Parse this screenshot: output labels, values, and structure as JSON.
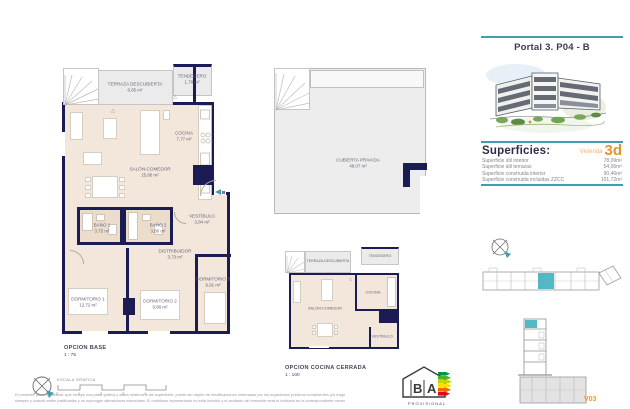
{
  "header": {
    "title": "Portal 3. P04 - B"
  },
  "superficies": {
    "title": "Superficies:",
    "vivienda_label": "Vivienda",
    "vivienda_code": "3d",
    "rows": [
      {
        "label": "Superficie útil interior",
        "value": "78,09m²"
      },
      {
        "label": "Superficie útil terrazas",
        "value": "54,06m²"
      },
      {
        "label": "Superficie construida interior",
        "value": "90,46m²"
      },
      {
        "label": "Superficie construida incluidas ZZCC",
        "value": "101,72m²"
      }
    ]
  },
  "plan_base": {
    "title": "OPCION BASE",
    "scale": "1 : 75",
    "section_marker": "B",
    "rooms": {
      "terraza": {
        "name": "TERRAZA DESCUBIERTA",
        "area": "6,85 m²"
      },
      "tendedero": {
        "name": "TENDEDERO",
        "area": "1,78 m²"
      },
      "cocina": {
        "name": "COCINA",
        "area": "7,77 m²"
      },
      "salon": {
        "name": "SALÓN-COMEDOR",
        "area": "25,86 m²"
      },
      "bano1": {
        "name": "BAÑO 1",
        "area": "3,75 m²"
      },
      "bano2": {
        "name": "BAÑO 2",
        "area": "3,86 m²"
      },
      "vestibulo": {
        "name": "VESTÍBULO",
        "area": "3,84 m²"
      },
      "distribuidor": {
        "name": "DISTRIBUIDOR",
        "area": "3,73 m²"
      },
      "dormitorio1": {
        "name": "DORMITORIO 1",
        "area": "12,72 m²"
      },
      "dormitorio2": {
        "name": "DORMITORIO 2",
        "area": "9,88 m²"
      },
      "dormitorio3": {
        "name": "DORMITORIO 3",
        "area": "9,91 m²"
      }
    }
  },
  "plan_cubierta": {
    "room": {
      "name": "CUBIERTA PRIVADA",
      "area": "48,07 m²"
    }
  },
  "plan_cerrada": {
    "title": "OPCION COCINA CERRADA",
    "scale": "1 : 100",
    "rooms": {
      "terraza": {
        "name": "TERRAZA DESCUBIERTA"
      },
      "tendedero": {
        "name": "TENDEDERO"
      },
      "salon": {
        "name": "SALÓN-COMEDOR"
      },
      "cocina": {
        "name": "COCINA"
      },
      "vestibulo": {
        "name": "VESTÍBULO"
      }
    }
  },
  "scalebar": {
    "label": "ESCALA GRÁFICA",
    "ticks": [
      "0",
      "1",
      "2",
      "3",
      "4"
    ]
  },
  "energy_logo": {
    "letter_b": "B",
    "letter_a": "A",
    "caption": "PROVISIONAL"
  },
  "footer": {
    "legal_line1": "El presente plano comercial, que incluye una parte gráfica y datos relativos a las superficies, puede ser objeto de modificaciones ordenadas por los organismos públicos competentes y/o exigencias técnicas o jurídicas,",
    "legal_line2": "siempre y cuando estén justificadas y no supongan alteraciones esenciales. El mobiliario representado no está incluido y el acabado del inmueble será el indicado en la correspondiente memoria de calidades.",
    "version": "V03"
  },
  "colors": {
    "wall": "#1c1c55",
    "floor": "#f3e7dc",
    "terrace": "#ebebeb",
    "accent_teal": "#3e9fb0",
    "accent_orange": "#e8912d"
  }
}
